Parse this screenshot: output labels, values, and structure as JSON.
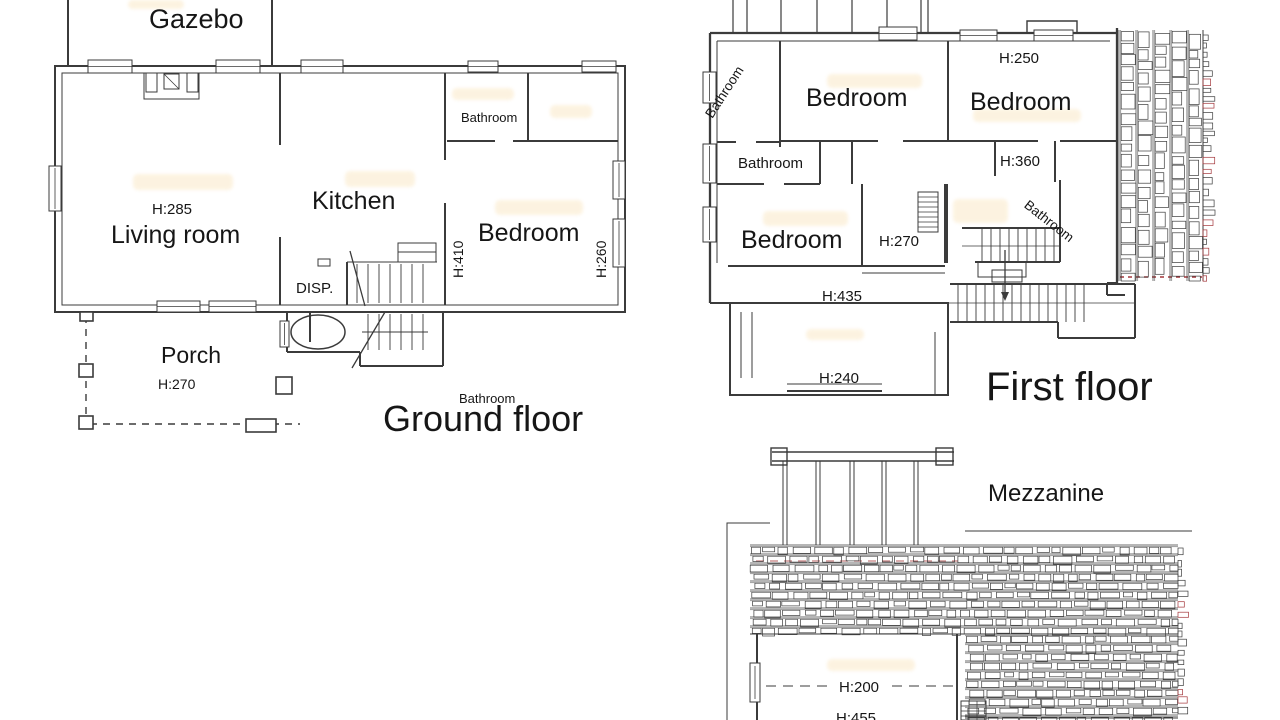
{
  "sheet": {
    "background": "#ffffff"
  },
  "colors": {
    "line": "#3b3b3b",
    "highlight": "#fcf0d9",
    "red_dash": "#a4373b"
  },
  "floors": {
    "ground": {
      "title": "Ground floor",
      "gazebo": "Gazebo",
      "living_room": "Living room",
      "living_room_height": "H:285",
      "kitchen": "Kitchen",
      "bathroom_top": "Bathroom",
      "bedroom": "Bedroom",
      "bedroom_height_left": "H:410",
      "bedroom_height_right": "H:260",
      "disp": "DISP.",
      "porch": "Porch",
      "porch_height": "H:270",
      "bathroom_bottom": "Bathroom"
    },
    "first": {
      "title": "First floor",
      "bathroom_nw": "Bathroom",
      "bedroom_center": "Bedroom",
      "bedroom_right": "Bedroom",
      "bedroom_right_height": "H:250",
      "bathroom_west": "Bathroom",
      "bathroom_east": "Bathroom",
      "bathroom_east_height": "H:360",
      "bedroom_left": "Bedroom",
      "hall_height": "H:270",
      "opening_height": "H:435",
      "balcony_height": "H:240"
    },
    "mezzanine": {
      "title": "Mezzanine",
      "room_height_upper": "H:200",
      "room_height_lower": "H:455"
    }
  }
}
